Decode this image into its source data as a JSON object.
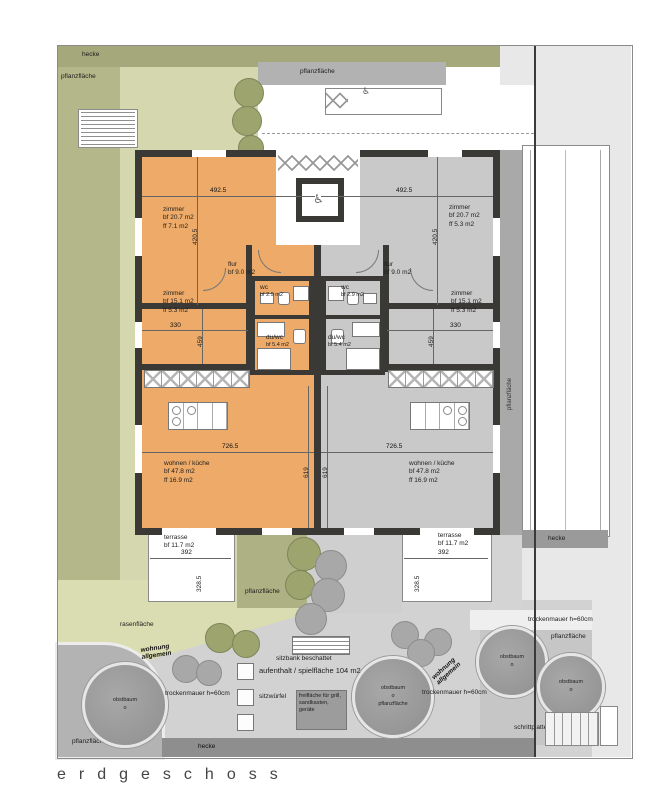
{
  "title": "erdgeschoss",
  "icons": {
    "wheelchair": "♿"
  },
  "labels": {
    "hecke": "hecke",
    "pflanzflaeche": "pflanzfläche",
    "rasenflaeche": "rasenfläche",
    "wohnung_allgemein": "wohnung allgemein",
    "obstbaum": "obstbaum",
    "o": "o",
    "trockenmauer": "trockenmauer h=60cm",
    "sitzbank": "sitzbank beschattet",
    "aufenthalt": "aufenthalt / spielfläche 104 m2",
    "sitzwuerfel": "sitzwürfel",
    "freiflaeche": "freifläche für grill, sandkasten, geräte",
    "schrittplatten": "schrittplatten"
  },
  "units": {
    "left": {
      "zimmer1": {
        "name": "zimmer",
        "bf": "bf 20.7 m2",
        "ff": "ff 7.1 m2"
      },
      "zimmer2": {
        "name": "zimmer",
        "bf": "bf 15.1 m2",
        "ff": "ff 5.3 m2"
      },
      "flur": {
        "name": "flur",
        "bf": "bf 9.0 m2"
      },
      "wc": {
        "name": "wc",
        "bf": "bf 2.9 m2"
      },
      "duwc": {
        "name": "du/wc",
        "bf": "bf 5.4 m2"
      },
      "wohnen": {
        "name": "wohnen / küche",
        "bf": "bf 47.8 m2",
        "ff": "ff 16.9 m2"
      },
      "terrasse": {
        "name": "terrasse",
        "bf": "bf 11.7 m2"
      }
    },
    "right": {
      "zimmer1": {
        "name": "zimmer",
        "bf": "bf 20.7 m2",
        "ff": "ff 5.3 m2"
      },
      "zimmer2": {
        "name": "zimmer",
        "bf": "bf 15.1 m2",
        "ff": "ff 5.3 m2"
      },
      "flur": {
        "name": "flur",
        "bf": "bf 9.0 m2"
      },
      "wc": {
        "name": "wc",
        "bf": "bf 2.9 m2"
      },
      "duwc": {
        "name": "du/wc",
        "bf": "bf 5.4 m2"
      },
      "wohnen": {
        "name": "wohnen / küche",
        "bf": "bf 47.8 m2",
        "ff": "ff 16.9 m2"
      },
      "terrasse": {
        "name": "terrasse",
        "bf": "bf 11.7 m2"
      }
    }
  },
  "dims": {
    "width_zimmer1": "492.5",
    "height_zimmer1": "420.5",
    "width_zimmer2": "330",
    "height_zimmer2": "459",
    "width_wohnen": "726.5",
    "height_wohnen": "619",
    "width_terrasse": "392",
    "height_terrasse": "328.5"
  },
  "colors": {
    "unit_left": "#edaa68",
    "unit_right": "#c9c9c9",
    "wall": "#3b3936",
    "hedge_green": "#a4a87a",
    "plant_green": "#b4b78a",
    "garden_green": "#d5d7ae",
    "lawn_green": "#dadcb2",
    "paving": "#d2d2d2"
  }
}
